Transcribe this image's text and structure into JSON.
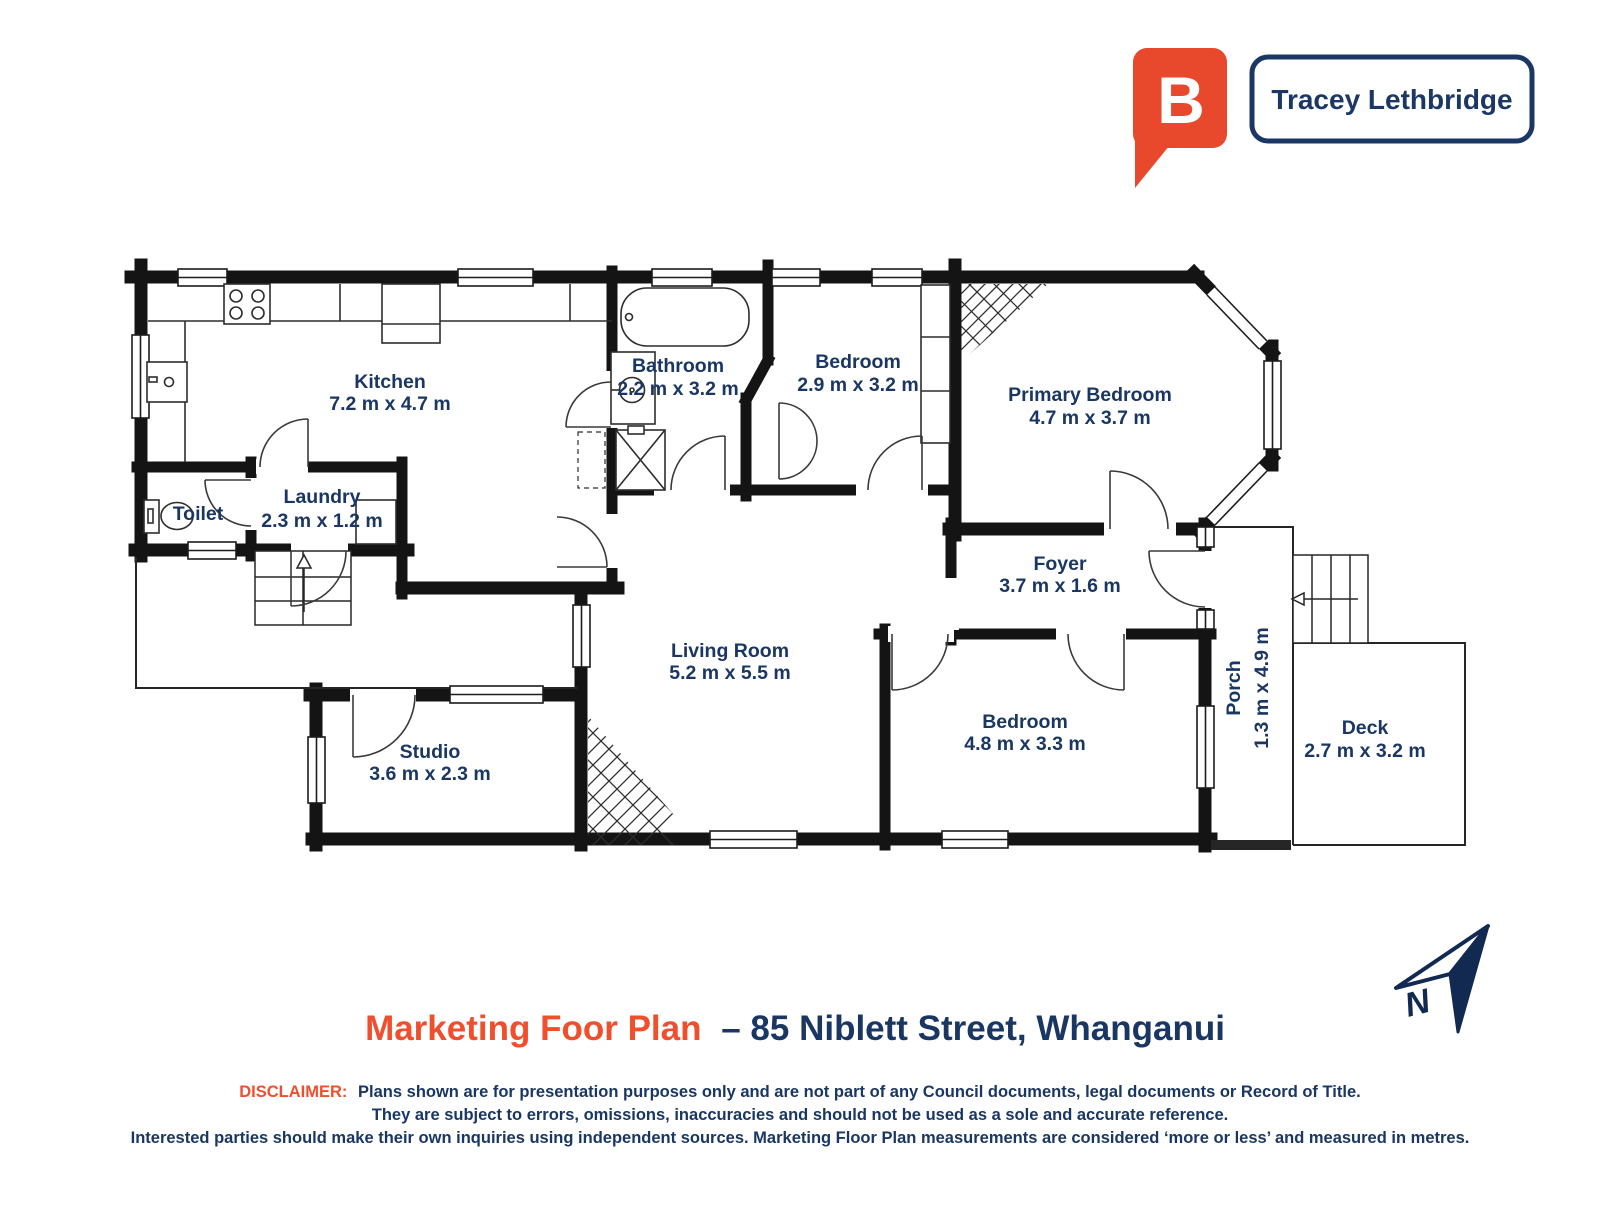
{
  "brand": {
    "logo_letter": "B",
    "agent_name": "Tracey Lethbridge",
    "bubble_color": "#e8492c",
    "navy": "#1b3865"
  },
  "rooms": {
    "kitchen": {
      "name": "Kitchen",
      "dims": "7.2 m x 4.7 m"
    },
    "toilet": {
      "name": "Toilet",
      "dims": ""
    },
    "laundry": {
      "name": "Laundry",
      "dims": "2.3 m x 1.2 m"
    },
    "bathroom": {
      "name": "Bathroom",
      "dims": "2.2 m x 3.2 m"
    },
    "bedroom2": {
      "name": "Bedroom",
      "dims": "2.9 m x 3.2 m"
    },
    "primary": {
      "name": "Primary Bedroom",
      "dims": "4.7 m x 3.7 m"
    },
    "foyer": {
      "name": "Foyer",
      "dims": "3.7 m x 1.6 m"
    },
    "living": {
      "name": "Living Room",
      "dims": "5.2 m x 5.5 m"
    },
    "bedroom3": {
      "name": "Bedroom",
      "dims": "4.8 m x 3.3 m"
    },
    "studio": {
      "name": "Studio",
      "dims": "3.6 m x 2.3 m"
    },
    "porch": {
      "name": "Porch",
      "dims": "1.3 m x 4.9 m"
    },
    "deck": {
      "name": "Deck",
      "dims": "2.7 m x 3.2 m"
    }
  },
  "title": {
    "plan_label": "Marketing Foor Plan",
    "address_part": "– 85 Niblett Street, Whanganui"
  },
  "disclaimer": {
    "label": "DISCLAIMER:",
    "line1": "Plans shown are for presentation purposes only and are not part of any Council documents, legal documents or Record of Title.",
    "line2": "They are subject to errors, omissions, inaccuracies and should not be used as a sole and accurate reference.",
    "line3": "Interested parties should make their own inquiries using independent sources. Marketing Floor Plan measurements are considered ‘more or less’ and measured in metres."
  },
  "compass": {
    "label": "N"
  },
  "colors": {
    "accent_orange": "#f04f2d",
    "text_navy": "#1a3763",
    "wall_black": "#141414"
  }
}
